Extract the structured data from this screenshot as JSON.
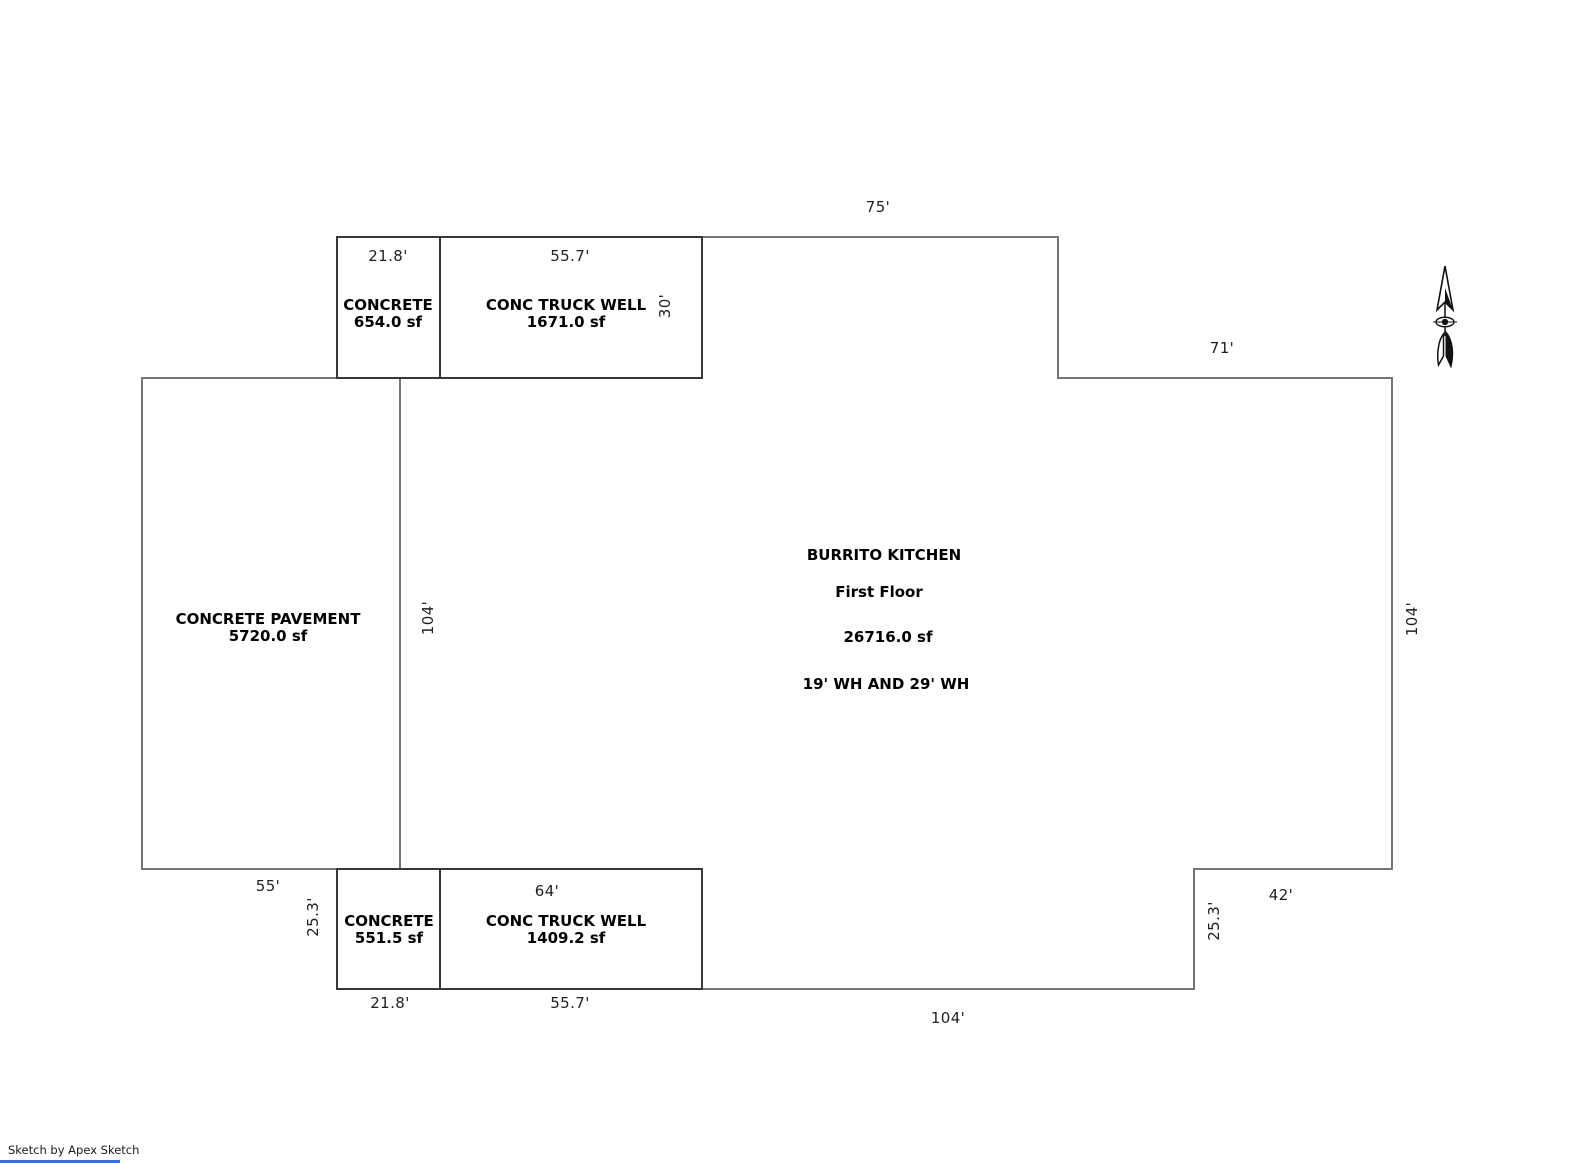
{
  "plan": {
    "building": {
      "name": "BURRITO KITCHEN",
      "floor": "First Floor",
      "area": "26716.0 sf",
      "note": "19' WH AND 29' WH"
    },
    "attachments": [
      {
        "label": "CONCRETE",
        "area": "654.0 sf"
      },
      {
        "label": "CONC TRUCK WELL",
        "area": "1671.0 sf"
      },
      {
        "label": "CONCRETE PAVEMENT",
        "area": "5720.0 sf"
      },
      {
        "label": "CONCRETE",
        "area": "551.5 sf"
      },
      {
        "label": "CONC TRUCK WELL",
        "area": "1409.2 sf"
      }
    ],
    "dimensions": {
      "top_75": "75'",
      "top_21_8": "21.8'",
      "top_55_7": "55.7'",
      "well_30": "30'",
      "right_71": "71'",
      "right_104": "104'",
      "west_104": "104'",
      "left_55": "55'",
      "left_25_3": "25.3'",
      "bottom_64": "64'",
      "right_42": "42'",
      "se_25_3": "25.3'",
      "bottom_21_8": "21.8'",
      "bottom_55_7": "55.7'",
      "bottom_104": "104'"
    }
  },
  "colors": {
    "outline": "#757575",
    "attachment_outline": "#383838",
    "accent_line": "#3f6bd6",
    "text": "#000000"
  },
  "footer": {
    "credit": "Sketch by Apex Sketch"
  }
}
